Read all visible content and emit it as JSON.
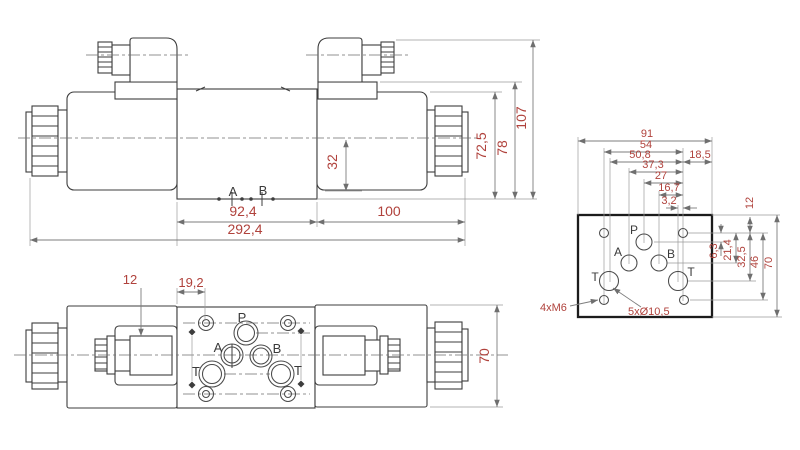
{
  "drawing": {
    "type": "technical-dimension-drawing",
    "subject": "hydraulic directional control valve with two solenoids and mounting plate interface",
    "colors": {
      "background": "#ffffff",
      "outline": "#3d3d3d",
      "dimension_text": "#b0423c",
      "dimension_line": "#7d7d7d",
      "plate_border": "#1c1c1c"
    },
    "side_view": {
      "port_a": "A",
      "port_b": "B",
      "dim_body_length": "92,4",
      "dim_coil_length": "100",
      "dim_total_length": "292,4",
      "dim_center_to_bottom": "32",
      "dim_coil_height": "72,5",
      "dim_body_height": "78",
      "dim_total_height": "107"
    },
    "top_view": {
      "dim_connector_offset": "12",
      "dim_hole_offset": "19,2",
      "dim_width": "70",
      "port_p": "P",
      "port_a": "A",
      "port_b": "B",
      "port_t1": "T",
      "port_t2": "T"
    },
    "plate_view": {
      "dim_91": "91",
      "dim_54": "54",
      "dim_50_8": "50,8",
      "dim_18_5": "18,5",
      "dim_37_3": "37,3",
      "dim_27": "27",
      "dim_16_7": "16,7",
      "dim_3_2": "3,2",
      "dim_12": "12",
      "dim_6_3": "6,3",
      "dim_21_4": "21,4",
      "dim_32_5": "32,5",
      "dim_46": "46",
      "dim_70": "70",
      "note_mounting_holes": "4xM6",
      "note_port_holes": "5xØ10,5",
      "port_p": "P",
      "port_a": "A",
      "port_b": "B",
      "port_t1": "T",
      "port_t2": "T"
    }
  }
}
